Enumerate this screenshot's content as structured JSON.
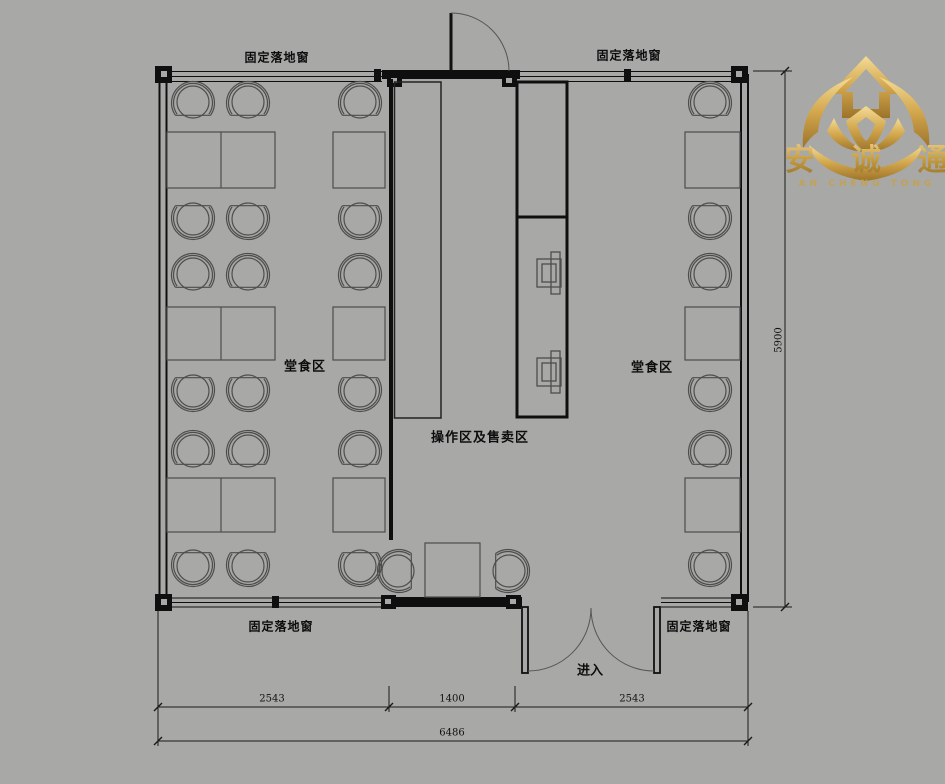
{
  "canvas": {
    "background": "#a8a8a6",
    "width": 945,
    "height": 784
  },
  "logo": {
    "company_cn": "安 诚 通",
    "company_en": "AN CHENG TONG"
  },
  "labels": {
    "window": "固定落地窗",
    "dining": "堂食区",
    "operation": "操作区及售卖区",
    "entry": "进入"
  },
  "dimensions": {
    "bottom_segments": [
      "2543",
      "1400",
      "2543"
    ],
    "bottom_total": "6486",
    "side_height": "5900"
  },
  "colors": {
    "wall": "#0f0f0f",
    "furniture": "#4d4d4d",
    "gold": "#c9a24a"
  }
}
